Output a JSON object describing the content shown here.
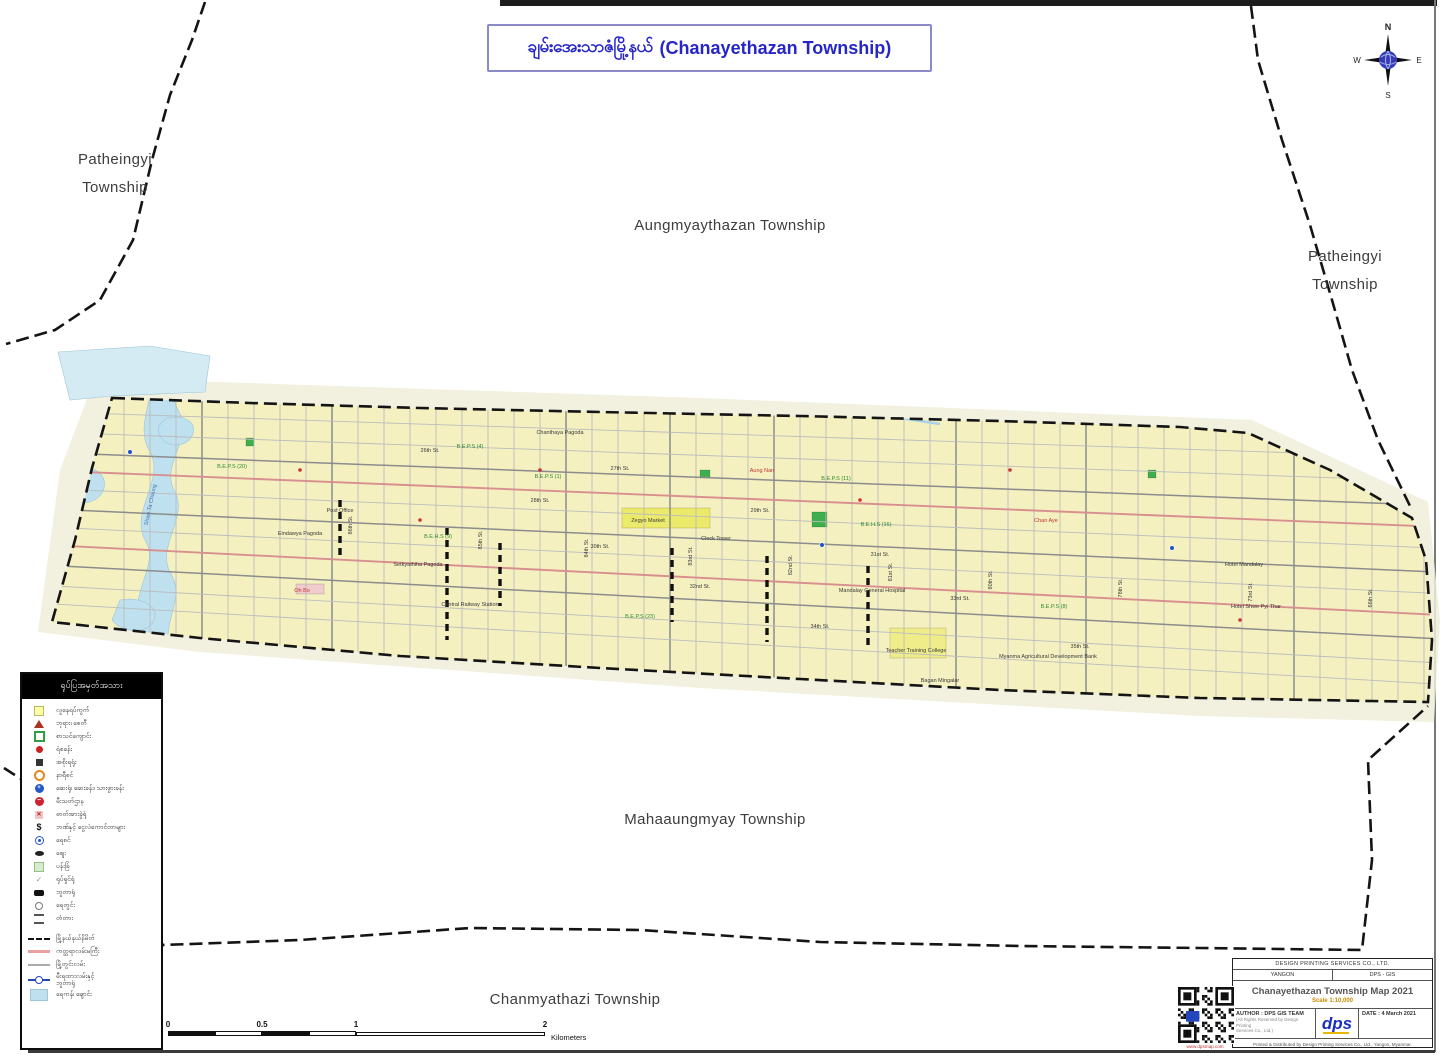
{
  "page_title": {
    "my": "ချမ်းအေးသာဇံမြို့နယ်",
    "en": "(Chanayethazan Township)"
  },
  "compass": {
    "n": "N",
    "e": "E",
    "s": "S",
    "w": "W"
  },
  "neighbors": {
    "patheingyi_left_1": "Patheingyi",
    "patheingyi_left_2": "Township",
    "aungmyaythazan": "Aungmyaythazan Township",
    "patheingyi_right_1": "Patheingyi",
    "patheingyi_right_2": "Township",
    "mahaaungmyay": "Mahaaungmyay Township",
    "chanmyathazi": "Chanmyathazi Township"
  },
  "legend": {
    "header": "ရုပ်ပြအမှတ်အသား",
    "items": [
      {
        "icon": "square-yellow",
        "label": "လူနေရပ်ကွက်"
      },
      {
        "icon": "triangle-red",
        "label": "ဘုရား၊ စေတီ"
      },
      {
        "icon": "school-green",
        "label": "စာသင်ကျောင်း"
      },
      {
        "icon": "dot-red",
        "label": "ရဲစခန်း"
      },
      {
        "icon": "square-dark",
        "label": "အစိုးရရုံး"
      },
      {
        "icon": "circle-orange",
        "label": "နာရီစင်"
      },
      {
        "icon": "circle-blue-cross",
        "glyph": "+",
        "label": "ဆေးရုံ၊ ဆေးခန်း၊ သားဖွားခန်း"
      },
      {
        "icon": "circle-red-bar",
        "glyph": "−",
        "label": "မီးသတ်ဌာန"
      },
      {
        "icon": "square-pink-x",
        "glyph": "✕",
        "label": "ဓာတ်အားခွဲရုံ"
      },
      {
        "icon": "glyph-dollar",
        "glyph": "$",
        "label": "ဘဏ်နှင့် ငွေလဲကောင်တာများ"
      },
      {
        "icon": "circle-blue-dot",
        "label": "ရေစင်"
      },
      {
        "icon": "oval-black",
        "label": "ဈေး"
      },
      {
        "icon": "square-green-pale",
        "label": "ပန်းခြံ"
      },
      {
        "icon": "tick-gray",
        "glyph": "✓",
        "label": "ရုပ်ရှင်ရုံ"
      },
      {
        "icon": "rect-black",
        "label": "ဘူတာရုံ"
      },
      {
        "icon": "circle-gray",
        "label": "ရေတွင်း"
      },
      {
        "icon": "bridge",
        "label": "တံတား"
      }
    ],
    "line_items": [
      {
        "icon": "line-dashed",
        "label": "မြို့နယ်နယ်နိမိတ်"
      },
      {
        "icon": "line-pink",
        "label": "ကတ္တရာလမ်းမကြီး"
      },
      {
        "icon": "line-gray",
        "label": "မြို့တွင်းလမ်း"
      },
      {
        "icon": "line-rail",
        "label": "မီးရထားလမ်းနှင့်",
        "label2": "ဘူတာရုံ"
      },
      {
        "icon": "patch-water",
        "label": "ရေကန်၊ ချောင်း"
      }
    ]
  },
  "scalebar": {
    "t0": "0",
    "t05": "0.5",
    "t1": "1",
    "t2": "2",
    "unit": "Kilometers"
  },
  "titleblock": {
    "company": "DESIGN PRINTING SERVICES CO., LTD.",
    "city": "YANGON",
    "dept": "DPS - GIS",
    "map_title": "Chanayethazan Township Map 2021",
    "scale": "Scale 1:10,000",
    "author": "AUTHOR : DPS GIS TEAM",
    "author_note1": "(All Rights Reserved by Design Printing",
    "author_note2": "Services Co., Ltd.)",
    "date": "DATE : 4 March 2021",
    "logo": "dps",
    "footer": "Printed & Distributed by Design Printing Services Co., Ltd., Yangon, Myanmar."
  },
  "qr_caption": "www.dpsmap.com",
  "map": {
    "colors": {
      "band_fill": "#F4F0C0",
      "halo_fill": "#F0EDD8",
      "water": "#BFE0EE",
      "water_light": "#D5EBF4",
      "street": "#BCBCBC",
      "street_major": "#8C8C8C",
      "street_red": "#D98F8F",
      "boundary": "#141414",
      "canal": "#A9D3E6",
      "label_dark": "#3a3a3a",
      "label_green": "#2e8b2e",
      "label_red": "#c03535",
      "label_blue": "#3a7ab8"
    },
    "halo": "95,378 700,398 1252,420 1428,502 1440,620 1434,722 1200,716 700,688 200,652 38,632 60,470",
    "band": "112,398 250,403 420,408 600,412 800,416 1000,421 1180,427 1248,433 1330,470 1412,518 1426,560 1432,640 1428,702 1200,698 1000,690 800,679 600,668 400,656 200,638 52,622 75,540 92,468",
    "water": [
      {
        "d": "M148,360 C162,392 132,422 150,452 C166,480 128,512 146,542 C160,566 126,596 142,626 L150,658 L172,652 C158,624 188,600 170,572 C156,546 190,516 174,490 C160,464 196,436 178,410 C168,388 170,372 166,360 Z",
        "light": false
      },
      {
        "d": "M70,470 C88,462 108,472 104,488 C100,504 76,508 66,496 C58,486 60,476 70,470 Z",
        "light": false
      },
      {
        "d": "M168,418 C186,414 198,424 192,436 C186,448 166,448 160,436 C156,428 160,422 168,418 Z",
        "light": false
      },
      {
        "d": "M120,600 C140,596 160,606 154,620 C148,634 122,634 112,620 Z",
        "light": false
      },
      {
        "d": "M58,352 L150,346 L210,356 L205,392 L112,396 L70,400 Z",
        "light": true
      }
    ],
    "canal": "M380,406 L480,400 L560,404 L660,398 L760,404 L860,412 L940,424",
    "patches": [
      {
        "x": 622,
        "y": 508,
        "w": 88,
        "h": 20,
        "f": "#ECEA6A"
      },
      {
        "x": 812,
        "y": 512,
        "w": 15,
        "h": 15,
        "f": "#3FAE4C"
      },
      {
        "x": 246,
        "y": 438,
        "w": 8,
        "h": 8,
        "f": "#3FAE4C"
      },
      {
        "x": 700,
        "y": 470,
        "w": 10,
        "h": 8,
        "f": "#3FAE4C"
      },
      {
        "x": 1148,
        "y": 470,
        "w": 8,
        "h": 8,
        "f": "#3FAE4C"
      },
      {
        "x": 890,
        "y": 628,
        "w": 56,
        "h": 30,
        "f": "#EFED8A"
      },
      {
        "x": 296,
        "y": 584,
        "w": 28,
        "h": 10,
        "f": "#F0CCCC"
      }
    ],
    "dots_blue": [
      [
        130,
        452
      ],
      [
        1172,
        548
      ],
      [
        822,
        545
      ]
    ],
    "dots_red": [
      [
        540,
        470
      ],
      [
        860,
        500
      ],
      [
        420,
        520
      ],
      [
        1010,
        470
      ],
      [
        300,
        470
      ],
      [
        1240,
        620
      ]
    ],
    "railways": [
      [
        447,
        528,
        640
      ],
      [
        500,
        543,
        606
      ],
      [
        672,
        548,
        622
      ],
      [
        767,
        556,
        642
      ],
      [
        868,
        566,
        648
      ],
      [
        340,
        500,
        556
      ]
    ],
    "major_v": [
      210,
      330,
      450,
      560,
      673,
      767,
      868,
      960,
      1092,
      1180,
      1300
    ],
    "boundaries": [
      "M205,2 L192,40 L170,95 L152,160 L133,240 L100,300 L55,330 L6,344",
      "M1251,6 L1258,60 L1282,140 L1310,225 L1332,300 L1352,370 L1378,440 L1410,506",
      "M4,768 L35,788 L82,845 L128,905 L163,945 L300,940 L470,928 L640,930 L820,942 L1020,946 L1200,948 L1362,950 L1372,860 L1368,760 L1428,706"
    ],
    "labels": [
      {
        "x": 430,
        "y": 452,
        "t": "26th St.",
        "c": "d"
      },
      {
        "x": 620,
        "y": 470,
        "t": "27th St.",
        "c": "d"
      },
      {
        "x": 540,
        "y": 502,
        "t": "28th St.",
        "c": "d"
      },
      {
        "x": 760,
        "y": 512,
        "t": "29th St.",
        "c": "d"
      },
      {
        "x": 600,
        "y": 548,
        "t": "30th St.",
        "c": "d"
      },
      {
        "x": 880,
        "y": 556,
        "t": "31st St.",
        "c": "d"
      },
      {
        "x": 700,
        "y": 588,
        "t": "32nd St.",
        "c": "d"
      },
      {
        "x": 960,
        "y": 600,
        "t": "33rd St.",
        "c": "d"
      },
      {
        "x": 820,
        "y": 628,
        "t": "34th St.",
        "c": "d"
      },
      {
        "x": 1080,
        "y": 648,
        "t": "35th St.",
        "c": "d"
      },
      {
        "x": 352,
        "y": 525,
        "t": "86th St.",
        "c": "d",
        "r": -90
      },
      {
        "x": 482,
        "y": 540,
        "t": "85th St.",
        "c": "d",
        "r": -90
      },
      {
        "x": 588,
        "y": 548,
        "t": "84th St.",
        "c": "d",
        "r": -90
      },
      {
        "x": 692,
        "y": 556,
        "t": "83rd St.",
        "c": "d",
        "r": -90
      },
      {
        "x": 792,
        "y": 565,
        "t": "82nd St.",
        "c": "d",
        "r": -90
      },
      {
        "x": 892,
        "y": 572,
        "t": "81st St.",
        "c": "d",
        "r": -90
      },
      {
        "x": 992,
        "y": 580,
        "t": "80th St.",
        "c": "d",
        "r": -90
      },
      {
        "x": 1122,
        "y": 588,
        "t": "78th St.",
        "c": "d",
        "r": -90
      },
      {
        "x": 1252,
        "y": 592,
        "t": "73rd St.",
        "c": "d",
        "r": -90
      },
      {
        "x": 1372,
        "y": 598,
        "t": "66th St.",
        "c": "d",
        "r": -90
      },
      {
        "x": 232,
        "y": 468,
        "t": "B.E.P.S (20)",
        "c": "g"
      },
      {
        "x": 470,
        "y": 448,
        "t": "B.E.P.S (4)",
        "c": "g"
      },
      {
        "x": 548,
        "y": 478,
        "t": "B.E.P.S (1)",
        "c": "g"
      },
      {
        "x": 836,
        "y": 480,
        "t": "B.E.P.S (11)",
        "c": "g"
      },
      {
        "x": 640,
        "y": 618,
        "t": "B.E.P.S (23)",
        "c": "g"
      },
      {
        "x": 1054,
        "y": 608,
        "t": "B.E.P.S (8)",
        "c": "g"
      },
      {
        "x": 438,
        "y": 538,
        "t": "B.E.H.S (9)",
        "c": "g"
      },
      {
        "x": 876,
        "y": 526,
        "t": "B.E.H.S (16)",
        "c": "g"
      },
      {
        "x": 300,
        "y": 535,
        "t": "Eindawya Pagoda",
        "c": "d"
      },
      {
        "x": 648,
        "y": 522,
        "t": "Zegyo Market",
        "c": "d"
      },
      {
        "x": 716,
        "y": 540,
        "t": "Clock Tower",
        "c": "d"
      },
      {
        "x": 470,
        "y": 606,
        "t": "Central Railway Station",
        "c": "d"
      },
      {
        "x": 418,
        "y": 566,
        "t": "Setkyathiha Pagoda",
        "c": "d"
      },
      {
        "x": 872,
        "y": 592,
        "t": "Mandalay General Hospital",
        "c": "d"
      },
      {
        "x": 916,
        "y": 652,
        "t": "Teacher Training College",
        "c": "d"
      },
      {
        "x": 1048,
        "y": 658,
        "t": "Myanma Agricultural Development Bank",
        "c": "d"
      },
      {
        "x": 1244,
        "y": 566,
        "t": "Hotel Mandalay",
        "c": "d"
      },
      {
        "x": 1256,
        "y": 608,
        "t": "Hotel Shwe Pyi Thar",
        "c": "d"
      },
      {
        "x": 940,
        "y": 682,
        "t": "Bagan Mingalar",
        "c": "d"
      },
      {
        "x": 340,
        "y": 512,
        "t": "Post Office",
        "c": "d"
      },
      {
        "x": 560,
        "y": 434,
        "t": "Chanthaya Pagoda",
        "c": "d"
      },
      {
        "x": 302,
        "y": 592,
        "t": "Oh Bo",
        "c": "r"
      },
      {
        "x": 762,
        "y": 472,
        "t": "Aung Nan",
        "c": "r"
      },
      {
        "x": 1046,
        "y": 522,
        "t": "Chan Aye",
        "c": "r"
      },
      {
        "x": 152,
        "y": 505,
        "t": "Shwe Ta Chaung",
        "c": "b",
        "r": -78
      }
    ]
  }
}
